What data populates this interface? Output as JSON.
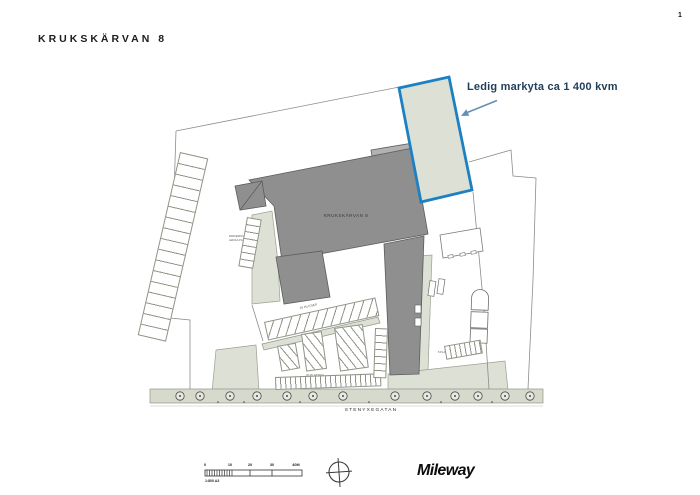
{
  "header": {
    "title": "KRUKSKÄRVAN 8",
    "page_number": "1"
  },
  "annotation": {
    "label": "Ledig markyta ca 1 400 kvm"
  },
  "plan": {
    "building_label": "KRUKSKÄRVAN 8",
    "street_label": "STENYXEGATAN",
    "parking_note_line1": "PARKERING",
    "parking_note_line2": "LEDIGA PLATSER",
    "upper_row_label": "26 PLATSER",
    "lower_row_label": "30 PLATSER",
    "dock_note": "8 PLATSER"
  },
  "scale_bar": {
    "ticks": [
      "0",
      "10",
      "20",
      "30",
      "40M"
    ],
    "ratio_label": "1:800 A3"
  },
  "footer": {
    "brand": "Mileway"
  },
  "colors": {
    "highlight_border": "#1d80c3",
    "building_gray": "#8f8f8f",
    "building_light_gray": "#b2b2b2",
    "surface_sage": "#dce0d5",
    "street_sage": "#d6dacd",
    "annotation_text": "#223f5a",
    "arrow_blue": "#6391b6"
  }
}
